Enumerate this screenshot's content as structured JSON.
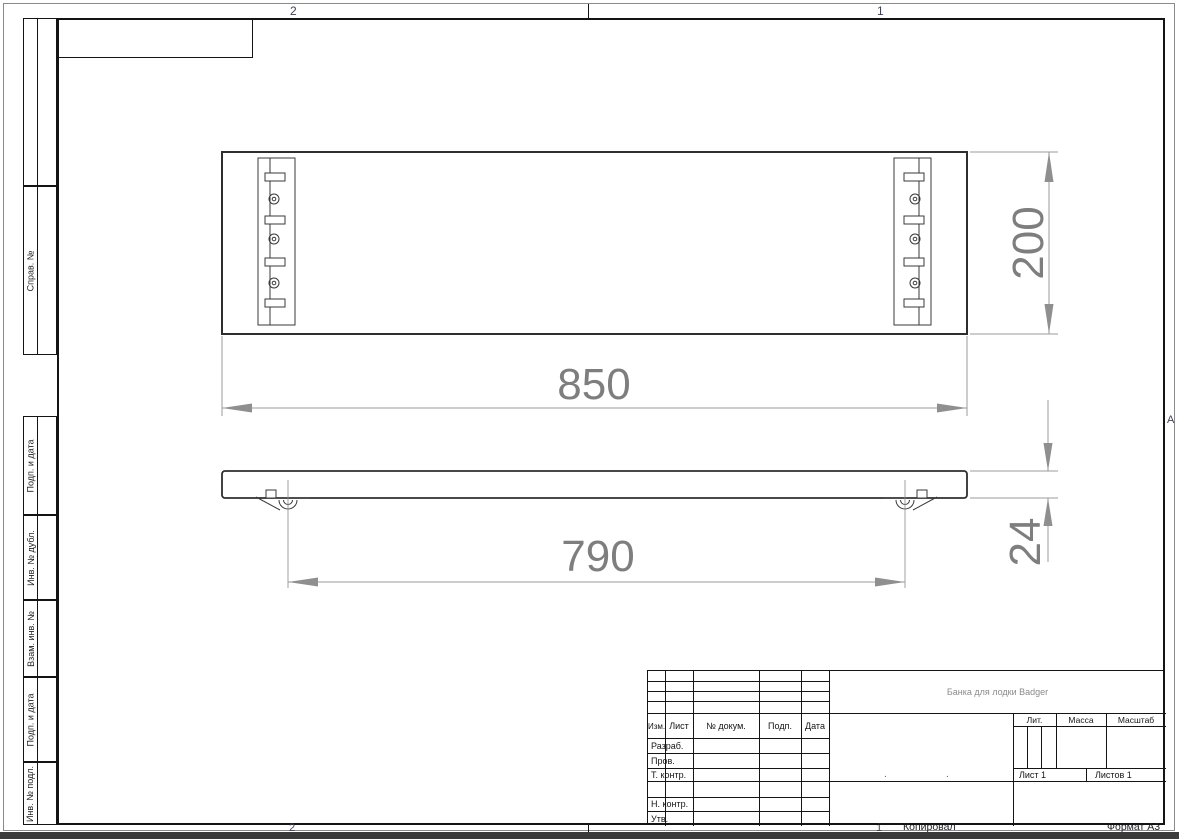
{
  "sheet": {
    "zones": {
      "top_left": "2",
      "top_right": "1",
      "bottom_left": "2",
      "bottom_right": "1",
      "right_middle": "A"
    },
    "footer": {
      "copied": "Копировал",
      "format": "Формат А3"
    }
  },
  "margin_cells": [
    {
      "label": ""
    },
    {
      "label": "Справ. №"
    },
    {
      "label": "Подп. и дата"
    },
    {
      "label": "Инв. № дубл."
    },
    {
      "label": "Взам. инв. №"
    },
    {
      "label": "Подп. и дата"
    },
    {
      "label": "Инв. № подл."
    }
  ],
  "dimensions": {
    "length": "850",
    "width": "200",
    "mount_span": "790",
    "thickness": "24"
  },
  "title_block": {
    "title": "Банка для лодки Badger",
    "header": {
      "izm": "Изм.",
      "list": "Лист",
      "dokum": "№ докум.",
      "podp": "Подп.",
      "data": "Дата"
    },
    "rows": {
      "razrab": "Разраб.",
      "prov": "Пров.",
      "t_kontr": "Т. контр.",
      "n_kontr": "Н. контр.",
      "utv": "Утв."
    },
    "right": {
      "lit": "Лит.",
      "massa": "Масса",
      "masshtab": "Масштаб",
      "list": "Лист 1",
      "listov": "Листов 1"
    },
    "dots": [
      ".",
      "."
    ]
  }
}
